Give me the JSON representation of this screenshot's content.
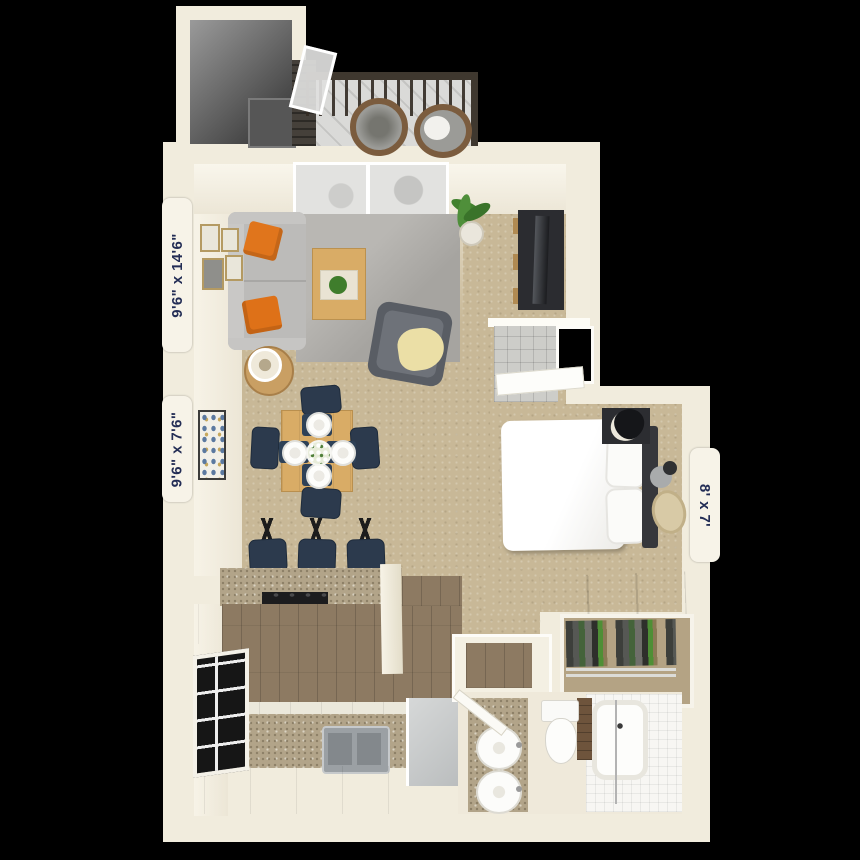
{
  "scene": {
    "type": "3d-apartment-floor-plan",
    "background_color": "#000000"
  },
  "dimension_labels": {
    "living_room": "9'6\" x 14'6\"",
    "dining_area": "9'6\" x 7'6\"",
    "bedroom": "8' x 7'"
  },
  "label_style": {
    "text_color": "#232d55",
    "tab_color": "#f7f3e8"
  },
  "palette": {
    "wall": "#f1ecdd",
    "carpet": "#c8b897",
    "wood_floor": "#8d7a62",
    "balcony_deck": "#dadad8",
    "rug": "#a6a4a0",
    "sofa": "#bcbbb9",
    "pillow_orange": "#e0751c",
    "chair_navy": "#2c3a4d",
    "table_wood": "#d9ac66",
    "granite": "#b2a489",
    "plant_green": "#41812e",
    "fixture_white": "#fdfdfb",
    "dark_furniture": "#2b2c30"
  },
  "rooms_visible": [
    "balcony",
    "storage",
    "living-room",
    "dining-area",
    "kitchen",
    "bedroom",
    "bathroom",
    "closet",
    "entry-closet",
    "desk-nook"
  ],
  "objects_visible": [
    "sofa",
    "orange-throw-pillows",
    "coffee-table",
    "armchair",
    "side-table-with-lamp",
    "tv-console",
    "wall-art-frames",
    "potted-plant",
    "dining-table-with-four-chairs",
    "bar-stools",
    "breakfast-bar",
    "cooktop",
    "double-kitchen-sink",
    "refrigerator",
    "kitchen-window",
    "bed",
    "nightstand",
    "hanging-clothes",
    "bathroom-vanity-two-sinks",
    "toilet",
    "bathtub-with-shower",
    "wicker-balcony-chairs",
    "balcony-railing",
    "sliding-glass-door"
  ]
}
